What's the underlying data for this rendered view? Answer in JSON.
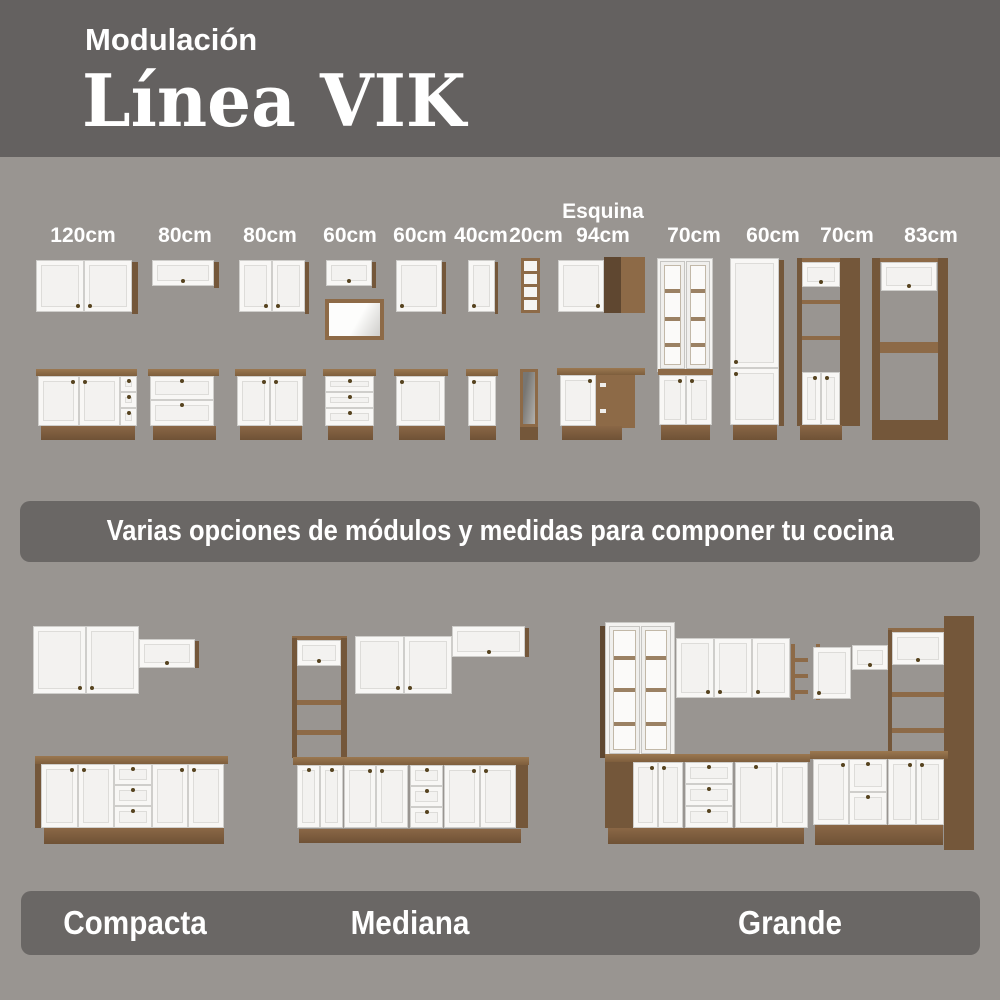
{
  "header": {
    "eyebrow": "Modulación",
    "title": "Línea VIK"
  },
  "modules_section": {
    "items": [
      {
        "label": "120cm",
        "type": "wall-cabinet-2-door + base-2-door-3-drawer"
      },
      {
        "label": "80cm",
        "type": "wall-flip-door + base-2-stacked-fronts"
      },
      {
        "label": "80cm",
        "type": "wall-cabinet-2-door + base-2-door"
      },
      {
        "label": "60cm",
        "type": "wall-flip-door + open-niche + base-3-drawer"
      },
      {
        "label": "60cm",
        "type": "wall-cabinet-1-door + base-1-door"
      },
      {
        "label": "40cm",
        "type": "wall-cabinet-1-door + base-1-door"
      },
      {
        "label": "20cm",
        "type": "open-shelf-wall-unit + open-base-unit"
      },
      {
        "label": "Esquina\n94cm",
        "type": "corner-wall-cabinet + corner-base-cabinet"
      },
      {
        "label": "70cm",
        "type": "tall-pantry-glass-doors"
      },
      {
        "label": "60cm",
        "type": "tall-pantry-solid-doors"
      },
      {
        "label": "70cm",
        "type": "tall-oven-tower-open-shelves"
      },
      {
        "label": "83cm",
        "type": "tall-fridge-surround-frame"
      }
    ]
  },
  "middle_banner": {
    "text": "Varias opciones de módulos y medidas para componer tu cocina"
  },
  "kitchens_section": {
    "items": [
      {
        "name": "Compacta"
      },
      {
        "name": "Mediana"
      },
      {
        "name": "Grande"
      }
    ]
  },
  "colors": {
    "header_bg": "#646160",
    "page_bg": "#999591",
    "banner_bg": "#6a6765",
    "text_white": "#ffffff",
    "wood": "#8d6a47",
    "wood_dark": "#74573a",
    "wood_deep": "#5f4730",
    "door_white": "#f3f2f0"
  }
}
